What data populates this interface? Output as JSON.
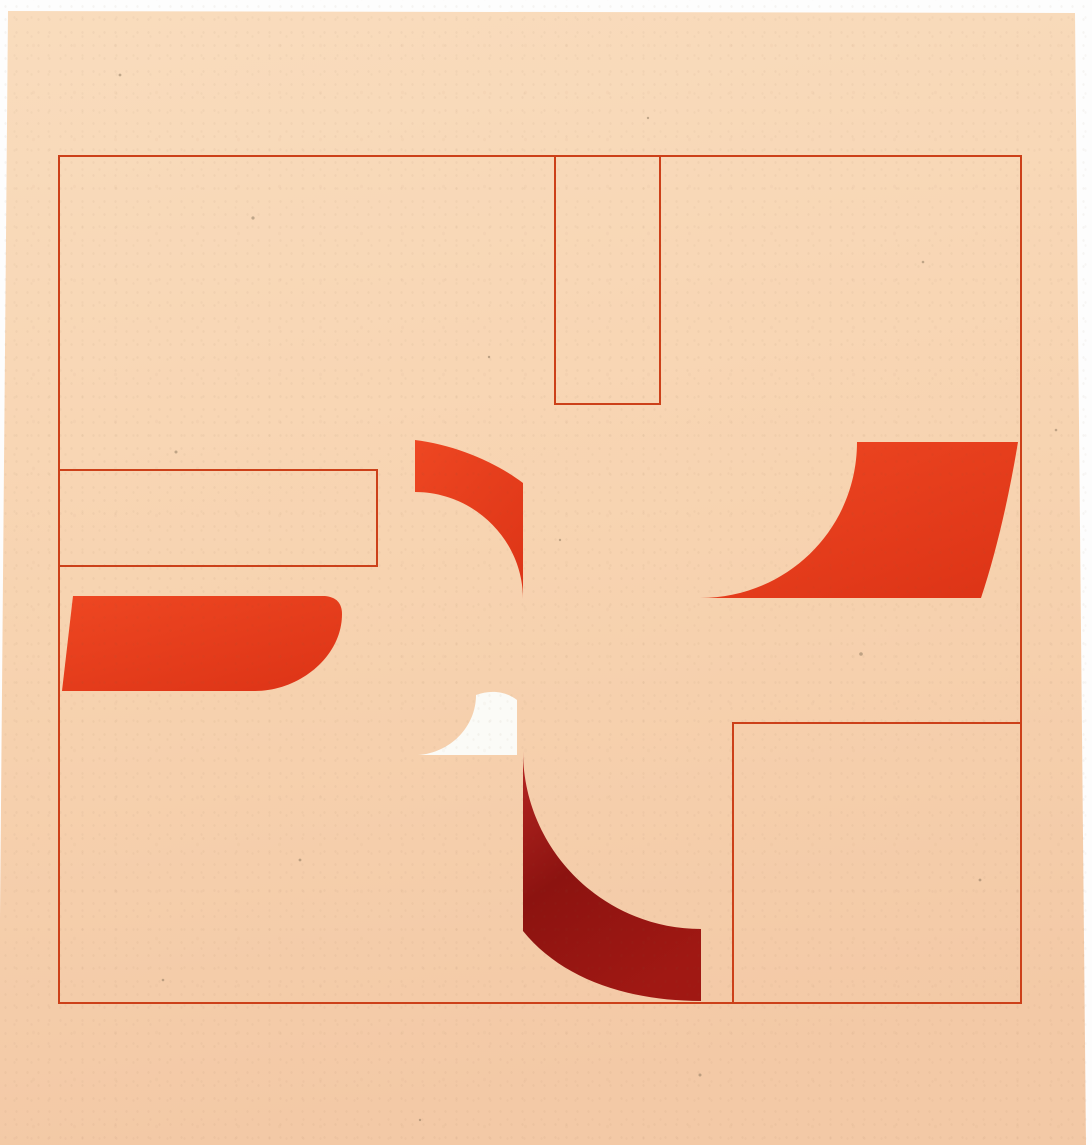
{
  "artwork": {
    "kind": "abstract-geometric-composition-photo",
    "description": "Photograph of an abstract artwork: thin red-outlined square frame with outlined rectangles and red curved fan shapes rotating around the center, on peach paper over a white backdrop",
    "palette": {
      "backdrop_white": "#fdfdfd",
      "paper_light": "#f9dcbd",
      "paper_mid": "#f7d3b0",
      "paper_dark": "#f3c9a6",
      "outline_red": "#cc4019",
      "red_bright": "#ee4722",
      "red_deep": "#de3517",
      "dark_red_bright": "#b32521",
      "dark_red_core": "#8c1310",
      "dark_red_low": "#a01813",
      "white_shape": "#fbfbf7",
      "speckle": "#7b6950"
    },
    "shapes": [
      {
        "name": "paper-sheet",
        "kind": "peach paper, slightly wider at bottom (camera perspective)"
      },
      {
        "name": "outer-frame-outline",
        "kind": "large outlined square, thin red line"
      },
      {
        "name": "hanging-rectangle-outline",
        "kind": "narrow outlined rectangle hanging from frame top edge"
      },
      {
        "name": "left-shelf-rectangle-outline",
        "kind": "outlined horizontal rectangle attached to frame left edge"
      },
      {
        "name": "bottom-right-square-outline",
        "kind": "outlined square sharing frame right and bottom edges"
      },
      {
        "name": "left-red-band",
        "kind": "solid red band from left edge, right end sweeps into concave curve"
      },
      {
        "name": "upper-red-fan",
        "kind": "solid red curved fan above center tapering to a needle tail"
      },
      {
        "name": "white-fan",
        "kind": "small white curved fan at center with leftward tail"
      },
      {
        "name": "dark-red-arc",
        "kind": "dark crimson quarter-ring arc below center"
      },
      {
        "name": "right-red-fan",
        "kind": "large red fan at right with concave lower-left sweep"
      }
    ]
  }
}
